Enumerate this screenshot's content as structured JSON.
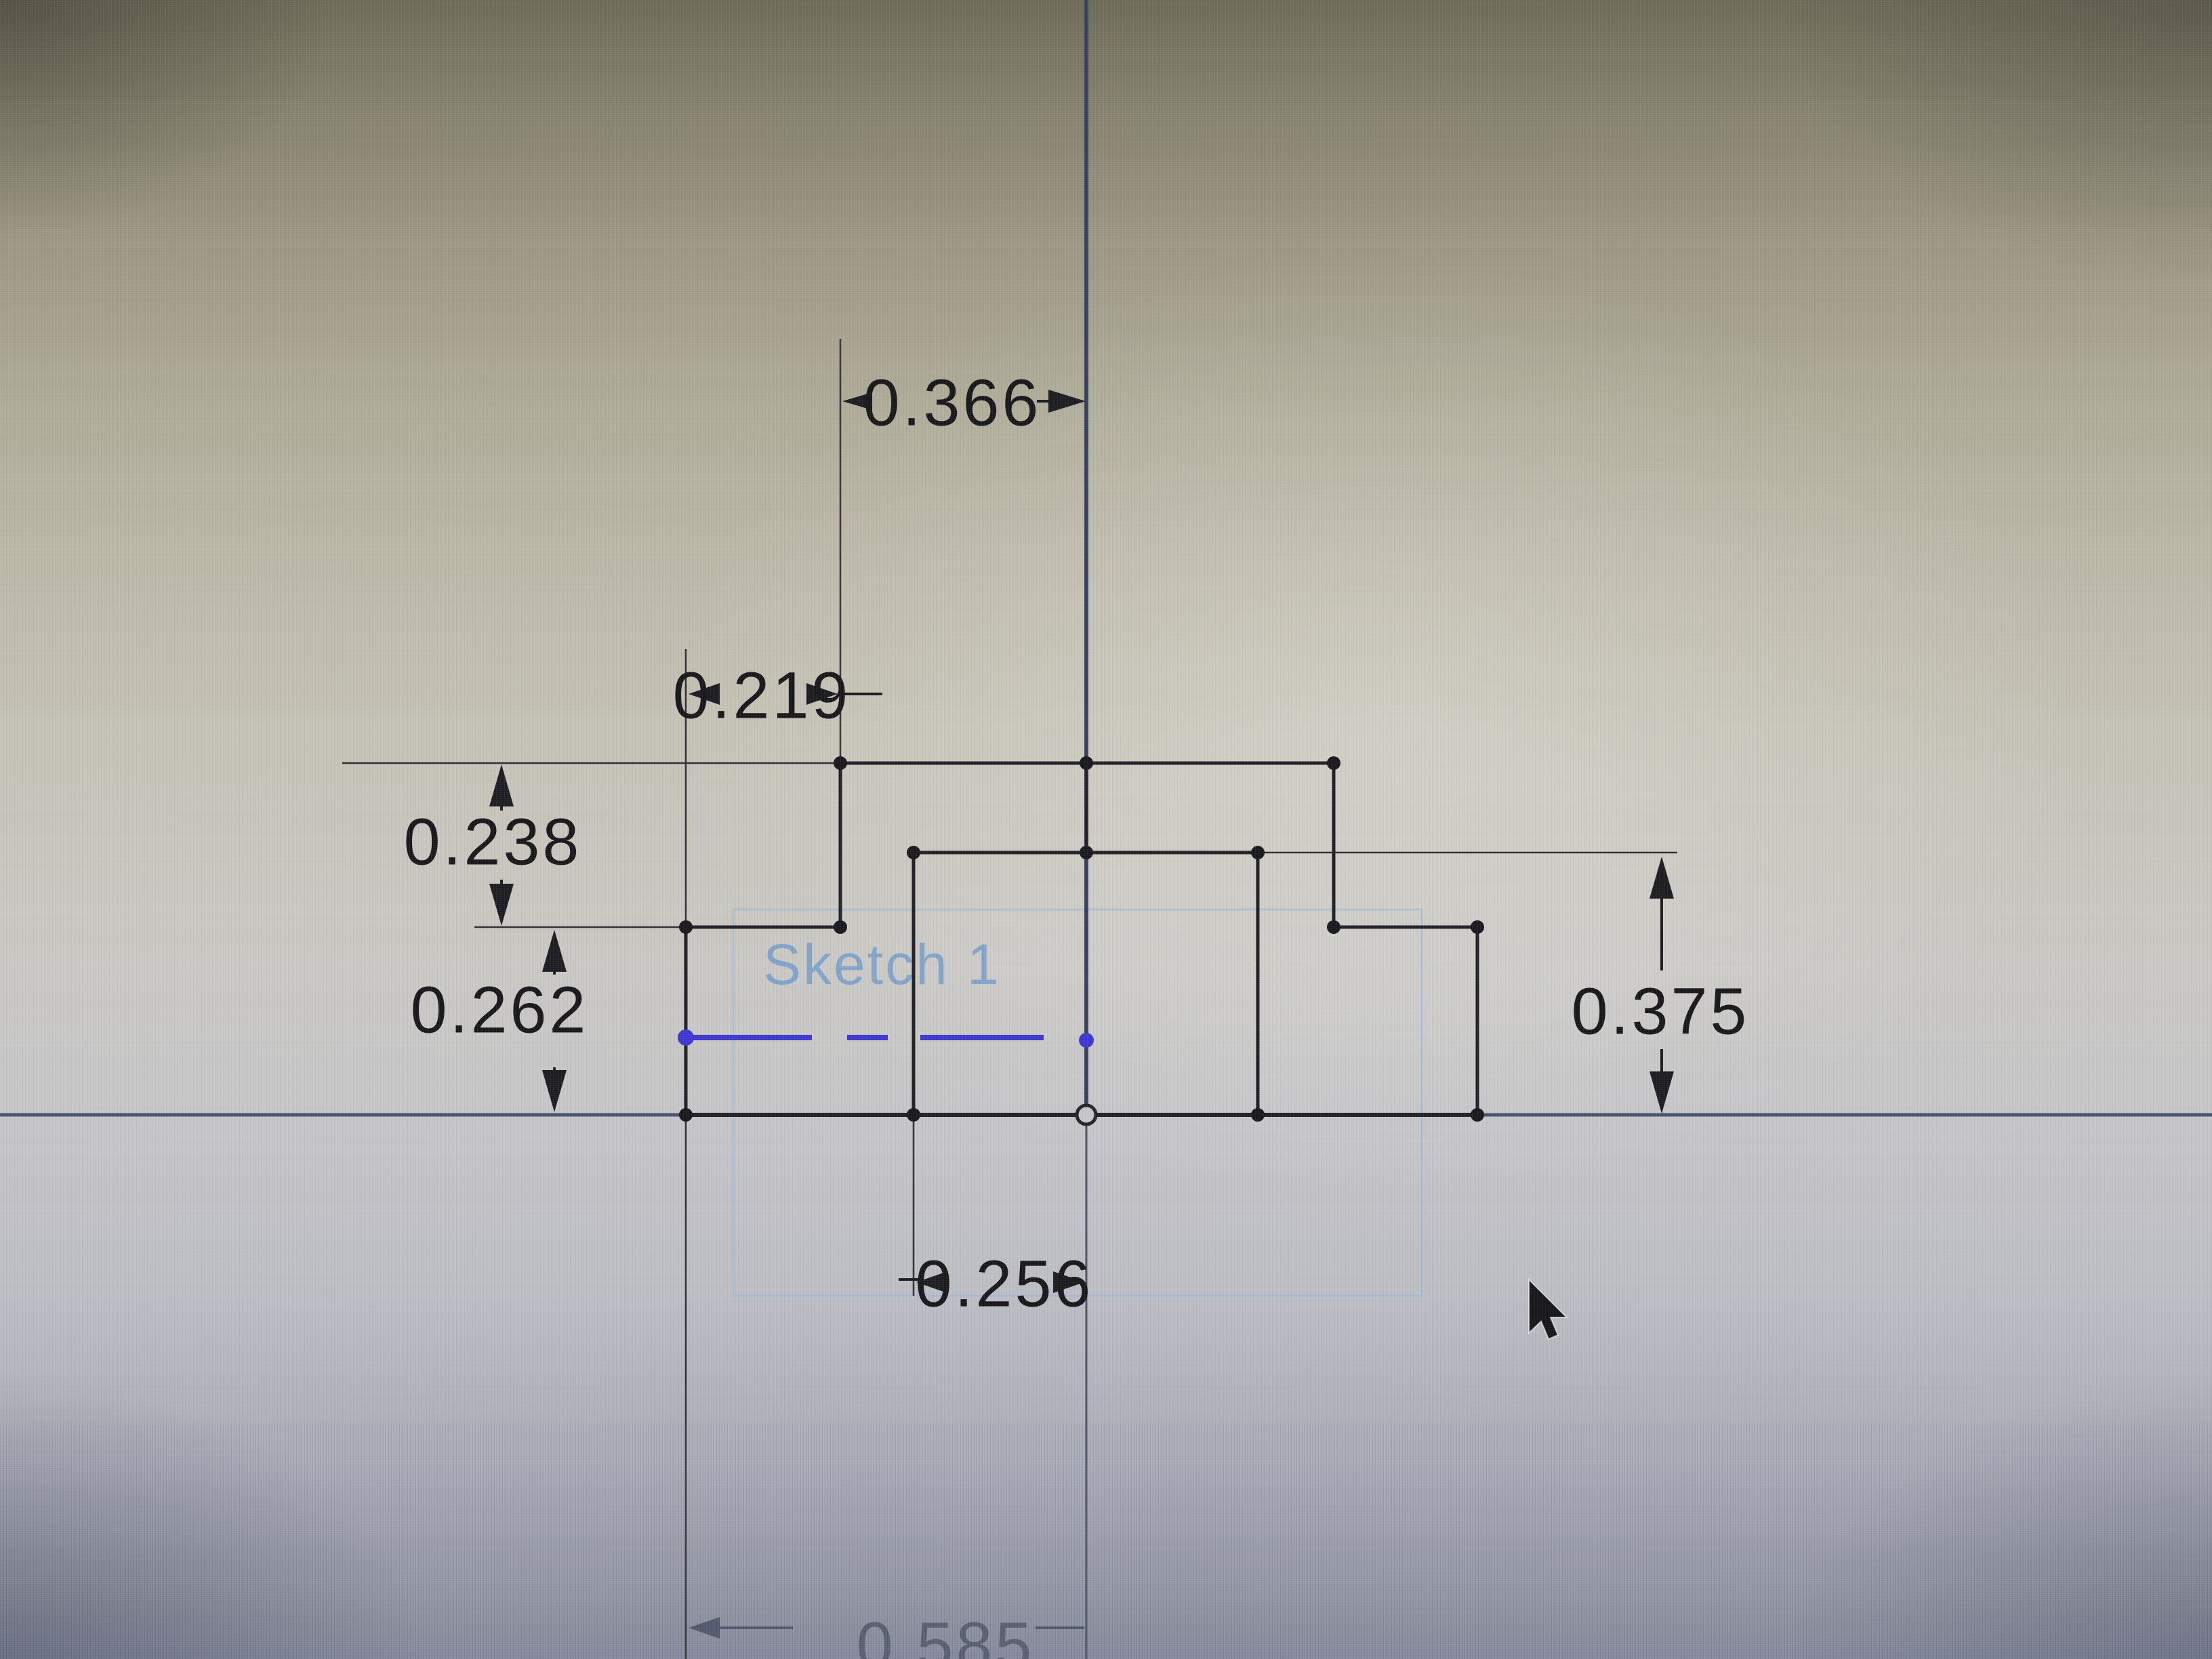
{
  "viewport": {
    "type": "cad-sketch-view",
    "sketch_label": "Sketch 1"
  },
  "dimensions": {
    "d366": "0.366",
    "d219": "0.219",
    "d238": "0.238",
    "d262": "0.262",
    "d375": "0.375",
    "d256": "0.256",
    "d585": "0.585"
  },
  "icons": {
    "origin": "origin-point-icon",
    "cursor": "cursor-arrow-icon"
  },
  "colors": {
    "geometry": "#1e1e24",
    "construction_blue": "#3d35cf",
    "axis": "#3c4a66",
    "sketch_region_blue": "#8fb6dc",
    "dimension_text": "#17171a",
    "faded_dimension_text": "#4e5465"
  }
}
